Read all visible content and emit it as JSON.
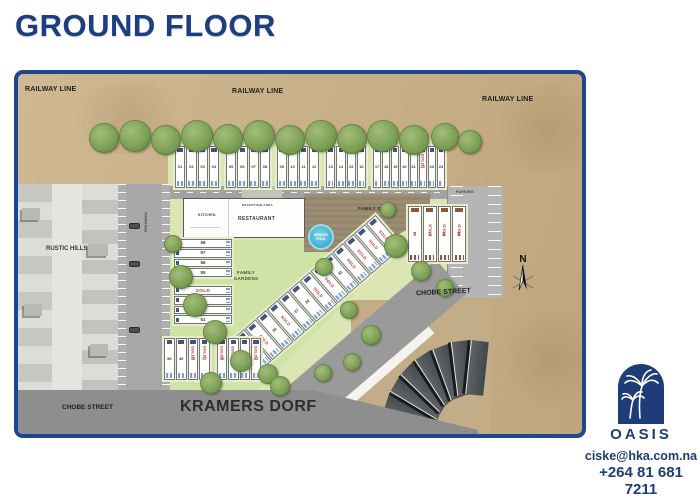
{
  "title": "GROUND FLOOR",
  "plan": {
    "railway_line": "RAILWAY LINE",
    "rustic_hills": "RUSTIC HILLS",
    "parking": "PARKING",
    "kitchen": "KITCHEN",
    "reception_area": "RECEPTION AREA",
    "restaurant": "RESTAURANT",
    "family_deck": "FAMILY DECK",
    "heated_pool": "HEATED POOL",
    "family_gardens": "FAMILY GARDENS",
    "chobe_street": "CHOBE STREET",
    "kramers_dorf": "KRAMERS DORF",
    "compass_north": "N",
    "sold_label": "SOLD"
  },
  "units": {
    "top_row": [
      {
        "list": [
          {
            "no": "01"
          },
          {
            "no": "02"
          },
          {
            "no": "03"
          },
          {
            "no": "04"
          }
        ]
      },
      {
        "list": [
          {
            "no": "05"
          },
          {
            "no": "06"
          },
          {
            "no": "07"
          },
          {
            "no": "08"
          }
        ]
      },
      {
        "list": [
          {
            "no": "09"
          },
          {
            "no": "10"
          },
          {
            "no": "11"
          },
          {
            "no": "12"
          }
        ]
      },
      {
        "list": [
          {
            "no": "13"
          },
          {
            "no": "14"
          },
          {
            "no": "15"
          },
          {
            "no": "16"
          }
        ]
      },
      {
        "list": [
          {
            "no": "17"
          },
          {
            "no": "18"
          },
          {
            "no": "19"
          },
          {
            "no": "20"
          },
          {
            "no": "21"
          },
          {
            "no": "22",
            "sold": true
          },
          {
            "no": "23"
          },
          {
            "no": "24"
          }
        ]
      }
    ],
    "left_column": [
      {
        "list": [
          {
            "no": "58"
          },
          {
            "no": "57"
          },
          {
            "no": "56"
          },
          {
            "no": "55"
          }
        ]
      },
      {
        "list": [
          {
            "no": "54",
            "sold": true
          },
          {
            "no": "53"
          },
          {
            "no": "52"
          },
          {
            "no": "51"
          }
        ]
      }
    ],
    "right_block": {
      "list": [
        {
          "no": "28"
        },
        {
          "no": "27",
          "sold": true
        },
        {
          "no": "26",
          "sold": true
        },
        {
          "no": "25",
          "sold": true
        }
      ]
    },
    "diagonal": {
      "list": [
        {
          "no": "42",
          "sold": true
        },
        {
          "no": "41",
          "sold": true
        },
        {
          "no": "40",
          "sold": true
        },
        {
          "no": "39"
        },
        {
          "no": "38",
          "sold": true
        },
        {
          "no": "37"
        },
        {
          "no": "36"
        },
        {
          "no": "35",
          "sold": true
        },
        {
          "no": "34",
          "sold": true
        },
        {
          "no": "33"
        },
        {
          "no": "32",
          "sold": true
        },
        {
          "no": "31",
          "sold": true
        },
        {
          "no": "30",
          "sold": true
        },
        {
          "no": "29",
          "sold": true
        }
      ]
    },
    "bottom_row": [
      {
        "list": [
          {
            "no": "50"
          },
          {
            "no": "49"
          },
          {
            "no": "48",
            "sold": true
          },
          {
            "no": "47",
            "sold": true
          }
        ]
      },
      {
        "list": [
          {
            "no": "46",
            "sold": true
          },
          {
            "no": "45",
            "sold": true
          },
          {
            "no": "44"
          },
          {
            "no": "43",
            "sold": true
          }
        ]
      }
    ]
  },
  "branding": {
    "logo_text": "OASIS",
    "email": "ciske@hka.com.na",
    "phone": "+264 81 681 7211"
  },
  "colors": {
    "brand_navy": "#1e3e7d",
    "sold_red": "#c1272d",
    "pool_blue": "#4fc0d8",
    "sand": "#c8b089",
    "road_gray": "#969696",
    "lawn_green": "#d5e3ae",
    "deck_brown": "#9a8a71"
  }
}
